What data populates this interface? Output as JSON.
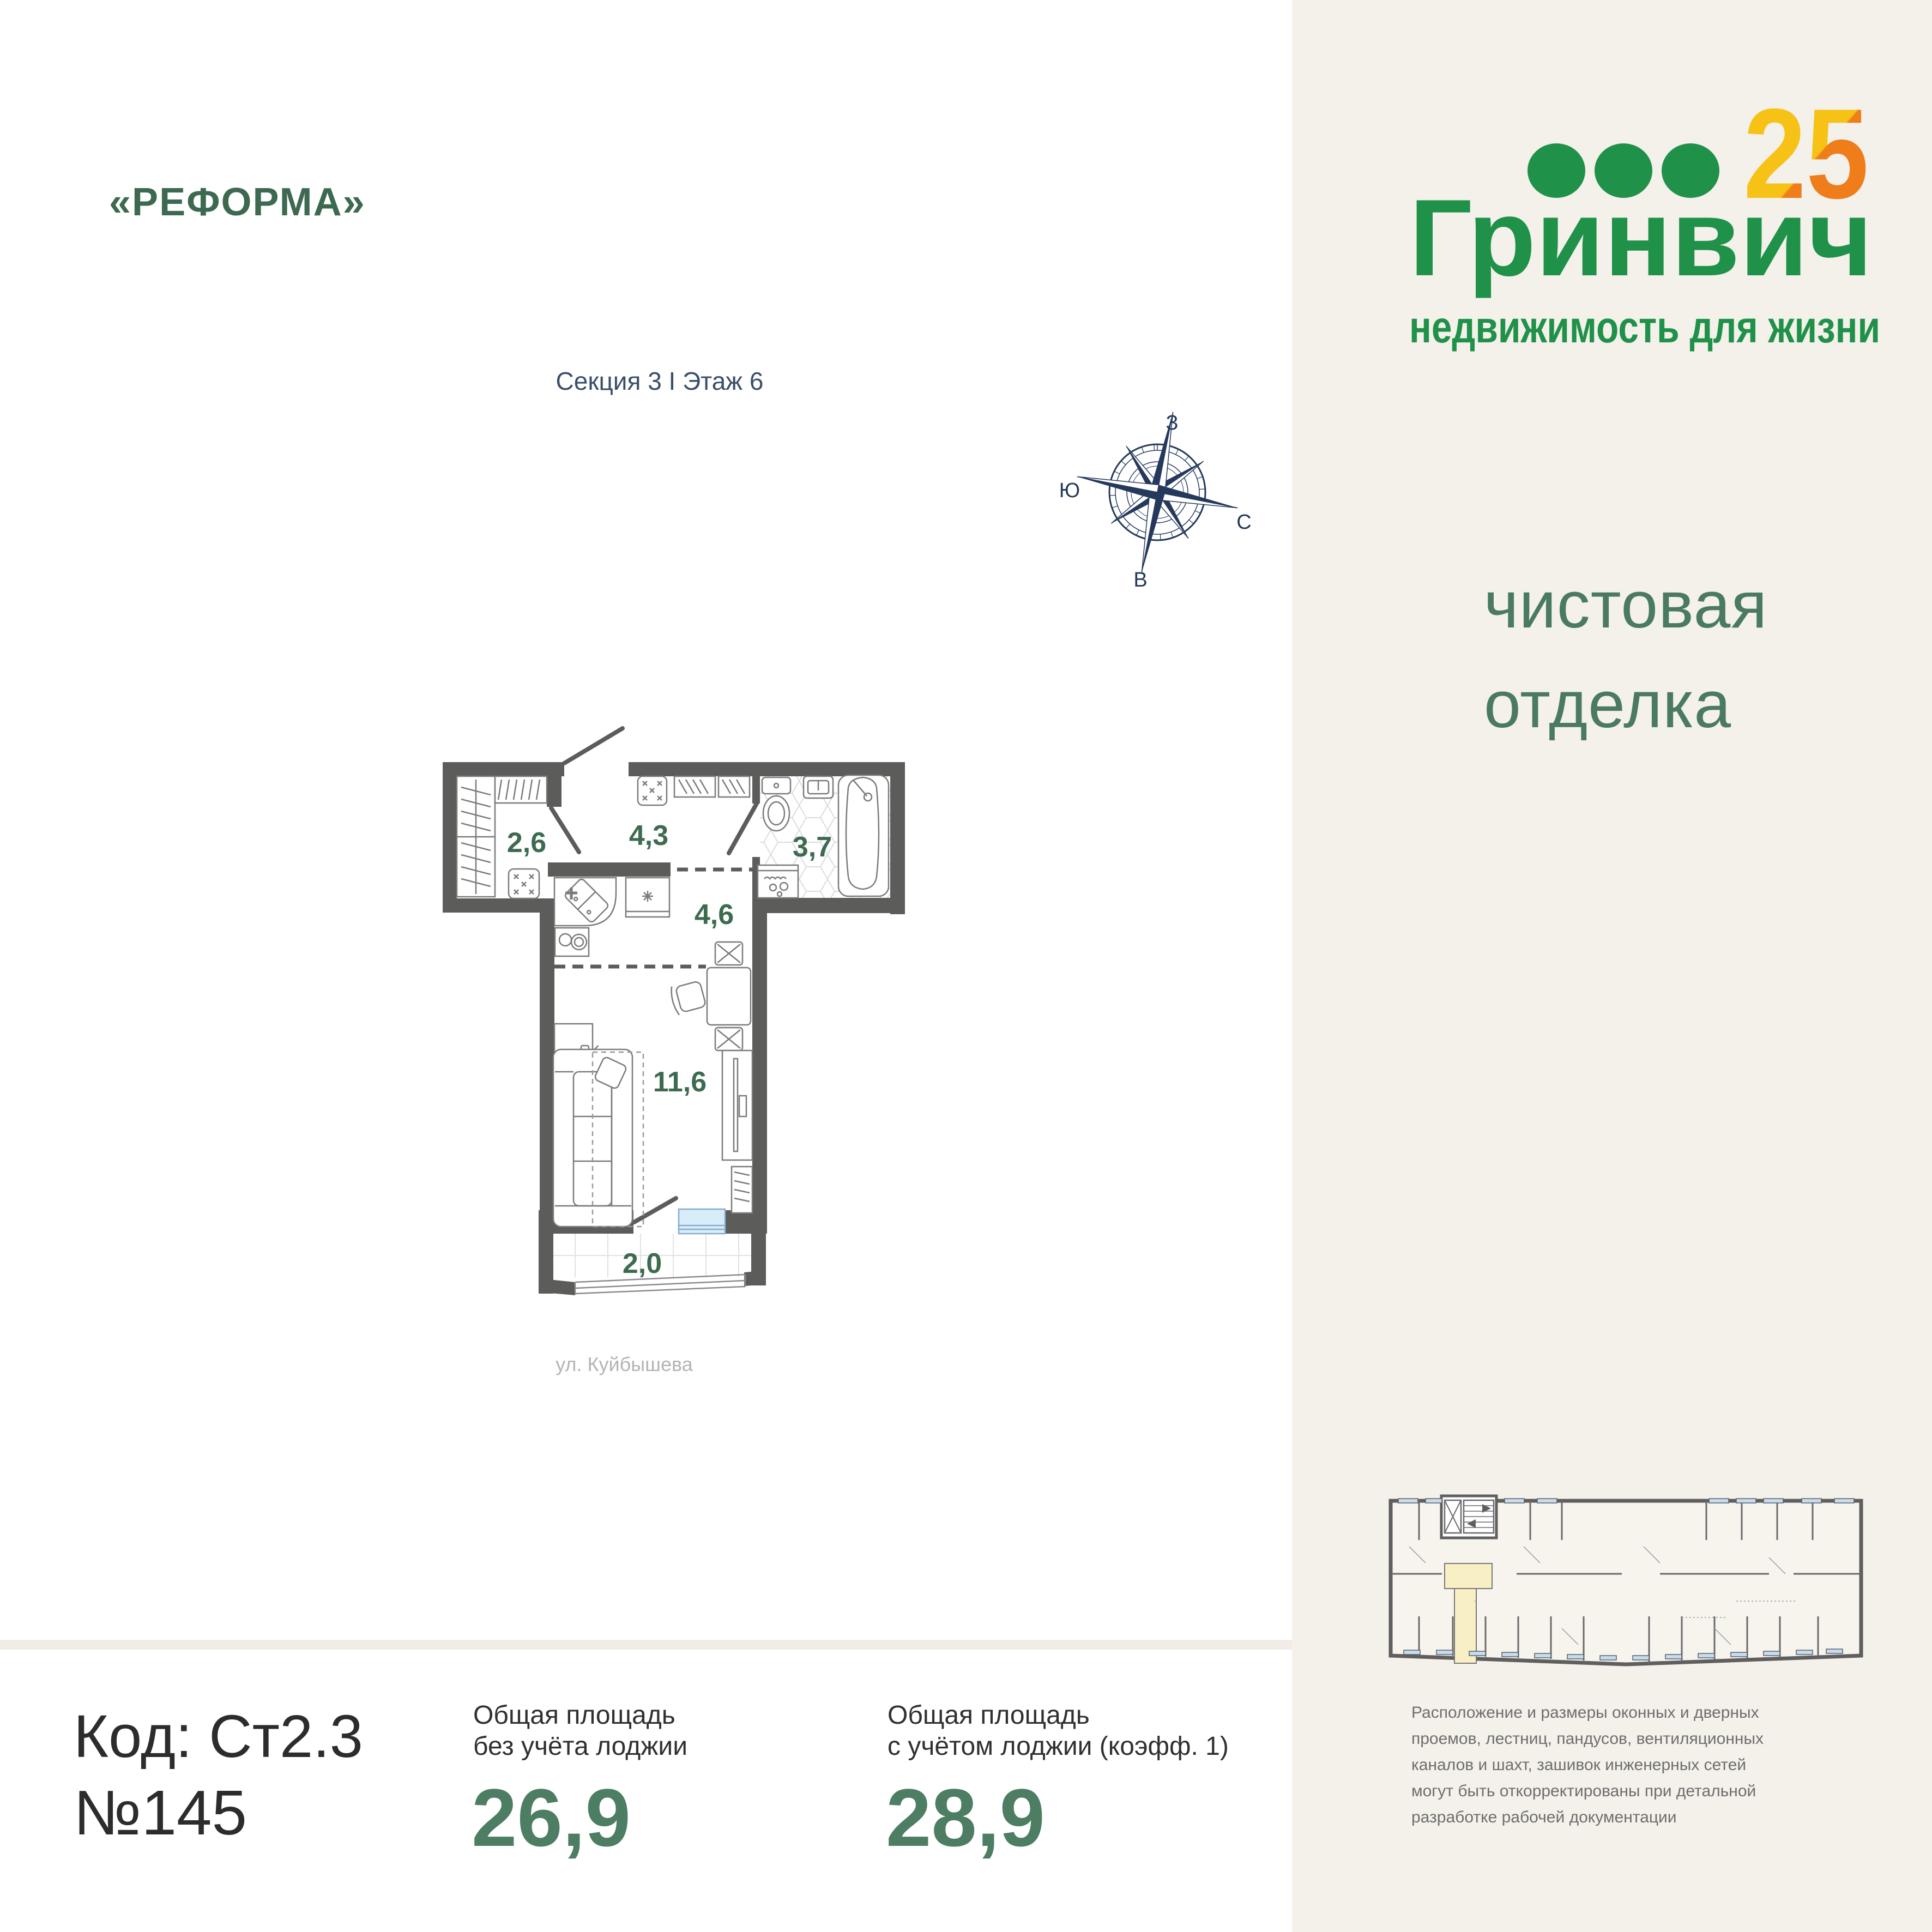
{
  "header": {
    "project_title": "«РЕФОРМА»",
    "section_floor": "Секция 3 I Этаж 6"
  },
  "logo": {
    "anniversary": "25",
    "brand": "Гринвич",
    "tagline": "недвижимость для жизни"
  },
  "finishing": {
    "line1": "чистовая",
    "line2": "отделка"
  },
  "compass": {
    "west": "З",
    "north": "С",
    "east": "В",
    "south": "Ю"
  },
  "plan": {
    "street": "ул. Куйбышева",
    "areas": {
      "hallway": "2,6",
      "kitchen_corridor": "4,3",
      "bathroom": "3,7",
      "kitchen": "4,6",
      "living": "11,6",
      "balcony": "2,0"
    }
  },
  "info": {
    "code": "Код: Ст2.3",
    "number": "№145",
    "area_without": {
      "label1": "Общая площадь",
      "label2": "без учёта лоджии",
      "value": "26,9"
    },
    "area_with": {
      "label1": "Общая площадь",
      "label2": "с учётом лоджии (коэфф. 1)",
      "value": "28,9"
    }
  },
  "disclaimer": {
    "lines": [
      "Расположение и размеры оконных и дверных",
      "проемов, лестниц, пандусов, вентиляционных",
      "каналов и шахт, зашивок инженерных сетей",
      "могут быть откорректированы при детальной",
      "разработке рабочей документации"
    ]
  },
  "colors": {
    "brand_green": "#1f9149",
    "accent_orange": "#ef7d1a",
    "accent_yellow": "#f6c216",
    "heading_green": "#3d6950",
    "finishing_green": "#4a7a5f",
    "area_green": "#4d7d63",
    "navy": "#24395b",
    "wall_gray": "#5c5c5a",
    "panel_cream": "#f4f0ea",
    "highlight_yellow": "#f9efc5",
    "window_blue": "#c3dcf2"
  }
}
